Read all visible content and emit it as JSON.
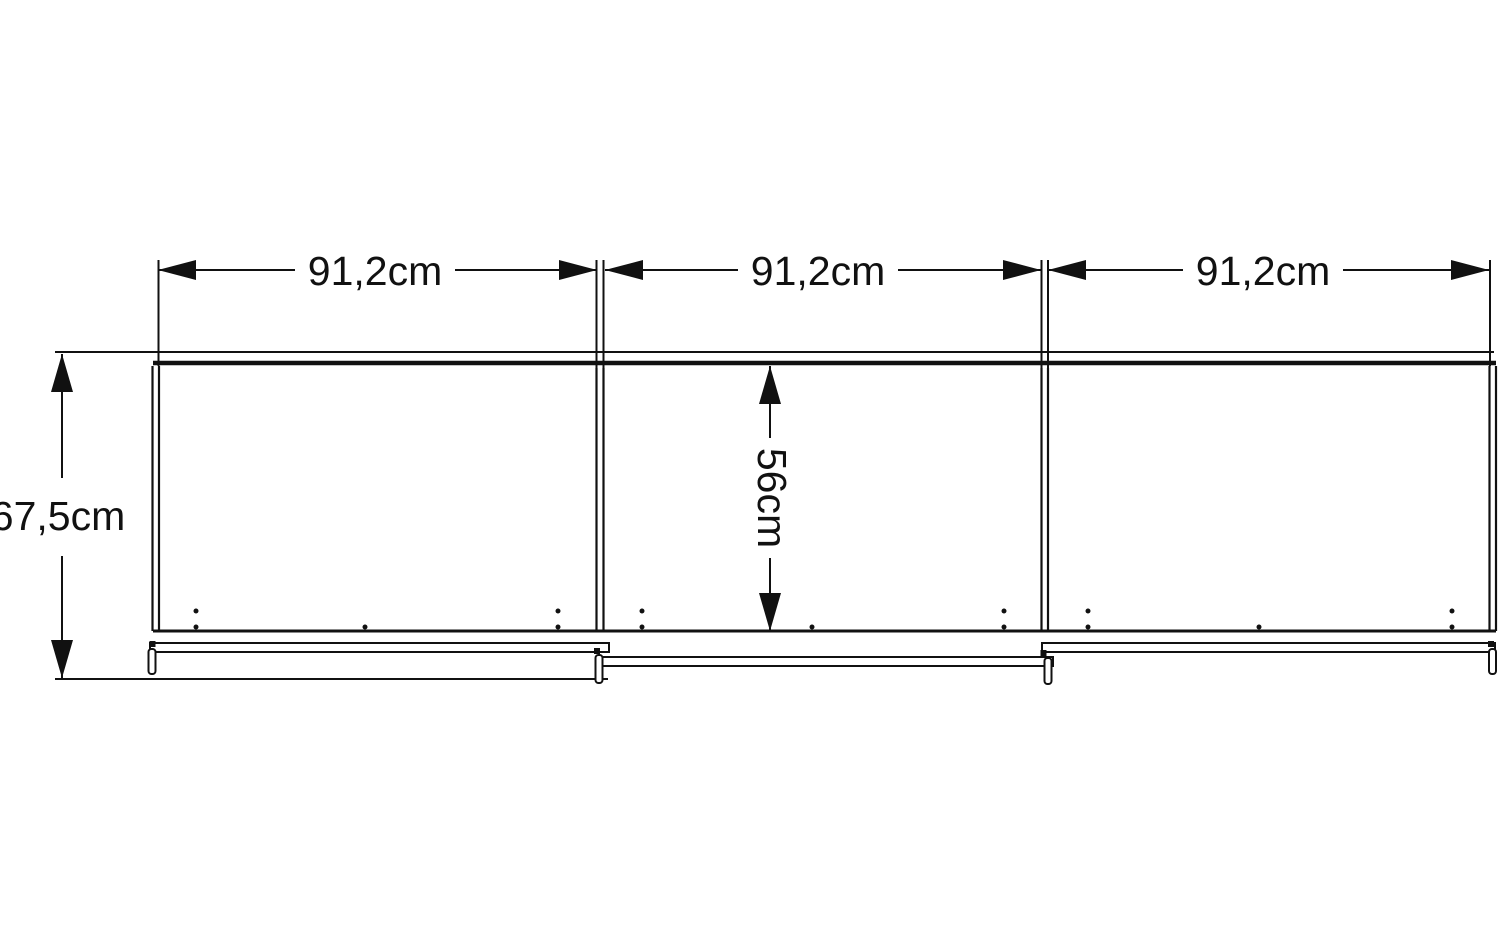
{
  "diagram": {
    "labels": {
      "door_width_1": "91,2cm",
      "door_width_2": "91,2cm",
      "door_width_3": "91,2cm",
      "overall_height": "67,5cm",
      "interior_height": "56cm"
    },
    "colors": {
      "line": "#111111",
      "background": "#ffffff"
    }
  }
}
